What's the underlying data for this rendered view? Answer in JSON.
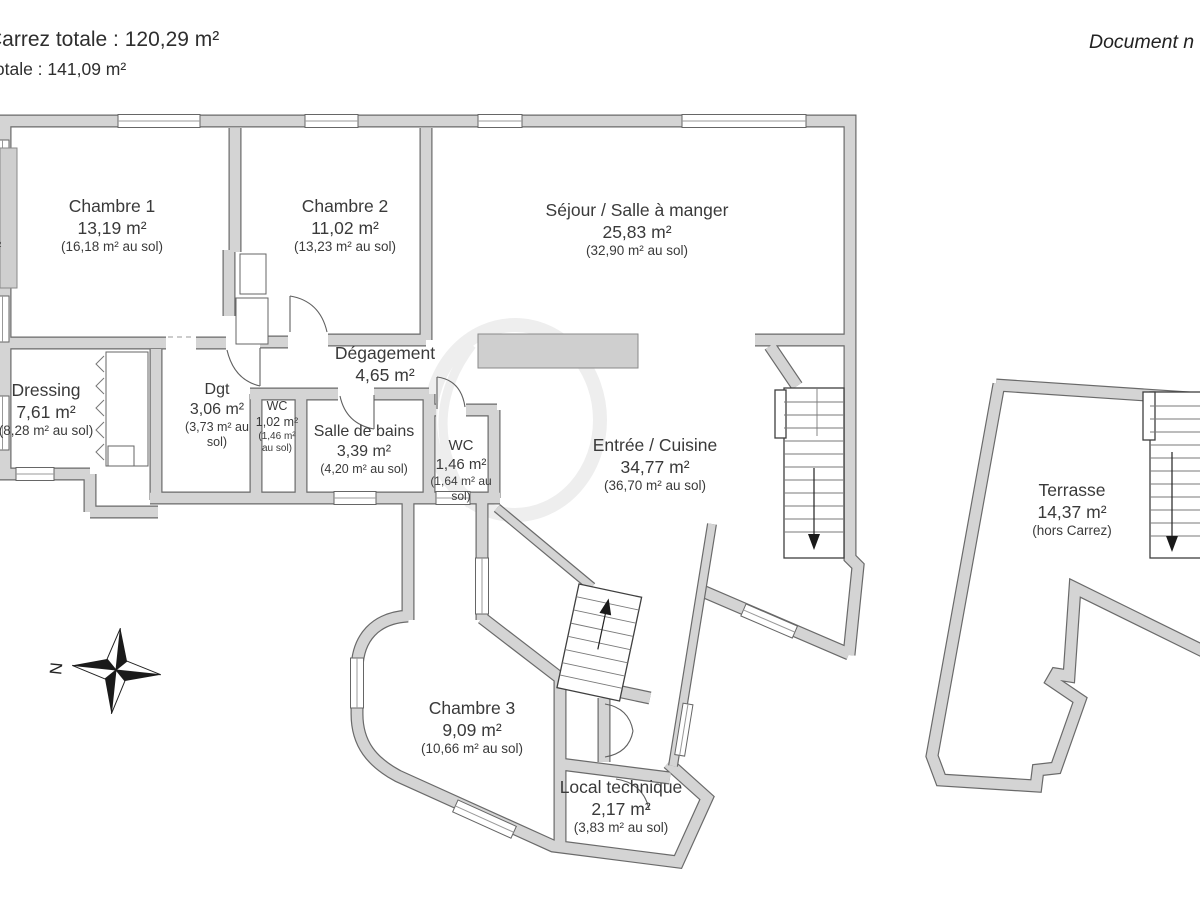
{
  "header": {
    "carrez_total": "Carrez totale :  120,29 m²",
    "surface_total": "totale :  141,09 m²",
    "doc_note": "Document n",
    "edge_cut_label": "m²"
  },
  "compass": {
    "north_label": "N"
  },
  "rooms": [
    {
      "id": "chambre1",
      "name": "Chambre 1",
      "area": "13,19 m²",
      "floor": "(16,18 m² au sol)"
    },
    {
      "id": "chambre2",
      "name": "Chambre 2",
      "area": "11,02 m²",
      "floor": "(13,23 m² au sol)"
    },
    {
      "id": "sejour",
      "name": "Séjour / Salle à manger",
      "area": "25,83 m²",
      "floor": "(32,90 m² au sol)"
    },
    {
      "id": "degagement",
      "name": "Dégagement",
      "area": "4,65 m²",
      "floor": ""
    },
    {
      "id": "dressing",
      "name": "Dressing",
      "area": "7,61 m²",
      "floor": "(8,28 m² au sol)"
    },
    {
      "id": "dgt",
      "name": "Dgt",
      "area": "3,06 m²",
      "floor": "(3,73 m² au sol)"
    },
    {
      "id": "wc1",
      "name": "WC",
      "area": "1,02 m²",
      "floor": "(1,46 m² au sol)"
    },
    {
      "id": "sdb",
      "name": "Salle de bains",
      "area": "3,39 m²",
      "floor": "(4,20 m² au sol)"
    },
    {
      "id": "wc2",
      "name": "WC",
      "area": "1,46 m²",
      "floor": "(1,64 m² au sol)"
    },
    {
      "id": "entree",
      "name": "Entrée / Cuisine",
      "area": "34,77 m²",
      "floor": "(36,70 m² au sol)"
    },
    {
      "id": "terrasse",
      "name": "Terrasse",
      "area": "14,37 m²",
      "floor": "(hors Carrez)"
    },
    {
      "id": "chambre3",
      "name": "Chambre 3",
      "area": "9,09 m²",
      "floor": "(10,66 m² au sol)"
    },
    {
      "id": "local",
      "name": "Local technique",
      "area": "2,17 m²",
      "floor": "(3,83 m² au sol)"
    }
  ],
  "colors": {
    "wall_fill": "#d4d4d4",
    "wall_edge": "#6a6a6a",
    "text": "#3a3a3a",
    "background": "#ffffff"
  }
}
